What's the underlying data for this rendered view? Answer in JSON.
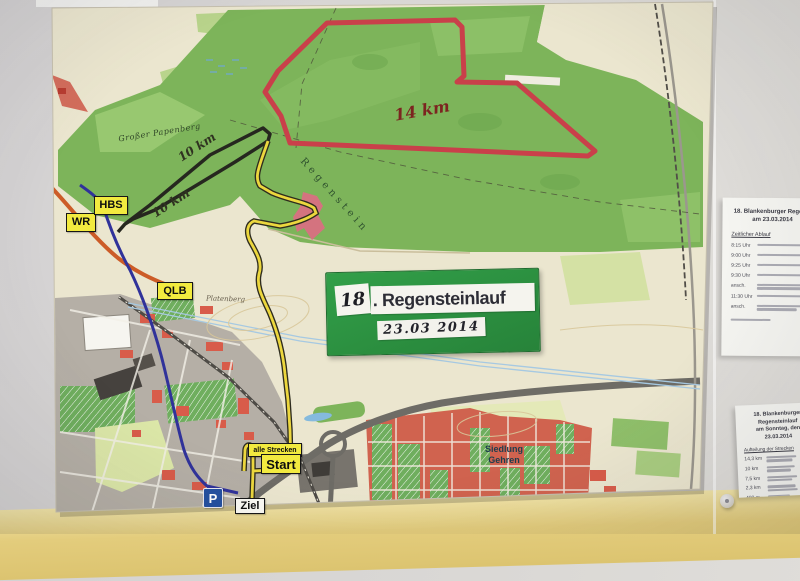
{
  "sign": {
    "number": "18",
    "title": ". Regensteinlauf",
    "date": "23.03 2014"
  },
  "route_markers": {
    "wr": "WR",
    "hbs": "HBS",
    "qlb": "QLB",
    "alle_strecken": "alle Strecken",
    "start": "Start",
    "ziel": "Ziel",
    "parking": "P",
    "red_distance": "14 km",
    "black_distance_upper": "10 km",
    "black_distance_lower": "10 km"
  },
  "toponyms": {
    "papenberg": "Großer Papenberg",
    "regenstein": "Regenstein",
    "platenberg": "Platenberg",
    "siedlung_line1": "Siedlung",
    "siedlung_line2": "Gehren"
  },
  "wall_sheets": {
    "schedule": {
      "title_line1": "18. Blankenburger Regenst",
      "title_line2": "am 23.03.2014",
      "heading": "Zeitlicher Ablauf",
      "times": [
        "8:15 Uhr",
        "9:00 Uhr",
        "9:25 Uhr",
        "9:30 Uhr",
        "ansch.",
        "11:30 Uhr",
        "ansch."
      ]
    },
    "distances": {
      "title_line1": "18. Blankenburger Regensteinlauf",
      "title_line2": "am Sonntag, den 23.03.2014",
      "heading": "Aufteilung der Strecken",
      "rows": [
        "14,3 km",
        "10 km",
        "7,5 km",
        "2,3 km",
        "400 m"
      ]
    }
  },
  "colors": {
    "map_sheet": "#f1ede0",
    "forest_green": "#7db45a",
    "route_red": "#c9404a",
    "route_yellow": "#ecd73e",
    "route_blue": "#30329a",
    "route_black": "#26271f",
    "road_orange": "#cc5c28",
    "sign_green": "#2b8e3f",
    "label_yellow": "#f2ea3f",
    "wall_yellow": "#e3cc7c",
    "town_red": "#d85c4a"
  }
}
